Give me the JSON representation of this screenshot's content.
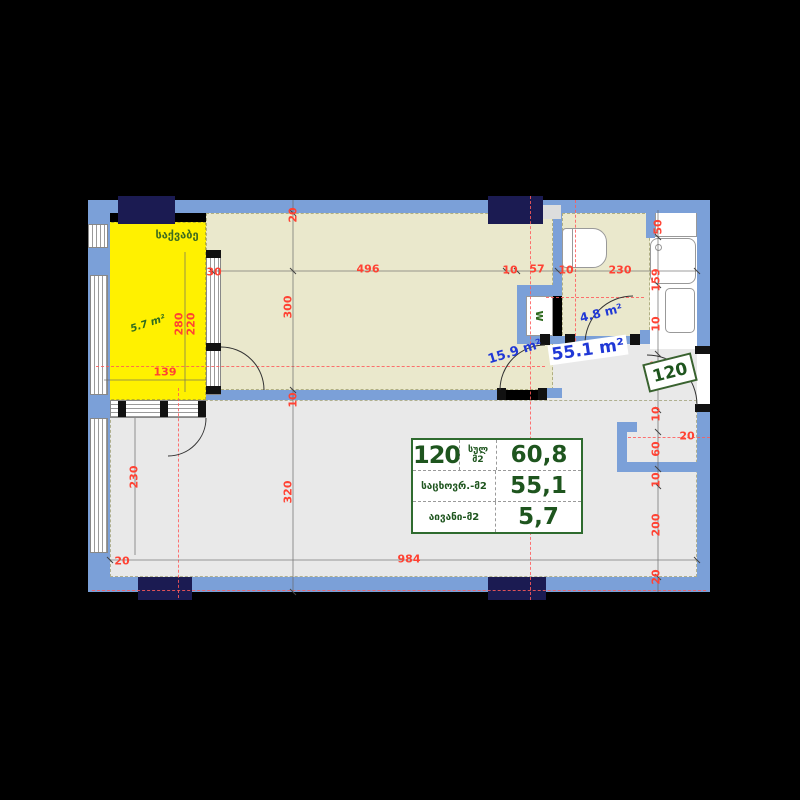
{
  "plan": {
    "unit_number": "120",
    "room_label_boiler": "საქვაბე",
    "areas": {
      "boiler": "5.7 m²",
      "hall": "15.9 m²",
      "bathroom": "4.8 m²",
      "living": "55.1 m²"
    },
    "wc_mark": "w",
    "entrance_badge": "120",
    "dims": {
      "top_offset": "20",
      "hall_width": "496",
      "d10a": "10",
      "d57": "57",
      "d10b": "10",
      "bath_width": "230",
      "shaft": "50",
      "shower": "159",
      "d10c": "10",
      "door30": "30",
      "balc_w1": "220",
      "balc_w2": "280",
      "balc_len": "139",
      "hall_h": "300",
      "d10d": "10",
      "living_h": "320",
      "left_h": "230",
      "bl20": "20",
      "living_w": "984",
      "entry142": "142",
      "d10e": "10",
      "niche60": "60",
      "niche20": "20",
      "d10f": "10",
      "right200": "200",
      "br20": "20"
    },
    "colors": {
      "wall": "#7BA0D8",
      "window_block": "#1B1B52",
      "boiler_room_fill": "#FFF100",
      "room_fill_beige": "#EAE8CC",
      "room_fill_gray": "#E9E9E9",
      "dim_red": "#FF4233",
      "area_blue": "#2038D6",
      "accent_green": "#1E551E"
    }
  },
  "area_table": {
    "unit": "120",
    "total_label_top": "სულ",
    "total_label_bottom": "მ2",
    "total_value": "60,8",
    "rows": [
      {
        "label": "საცხოვრ.-მ2",
        "value": "55,1"
      },
      {
        "label": "აივანი-მ2",
        "value": "5,7"
      }
    ]
  }
}
